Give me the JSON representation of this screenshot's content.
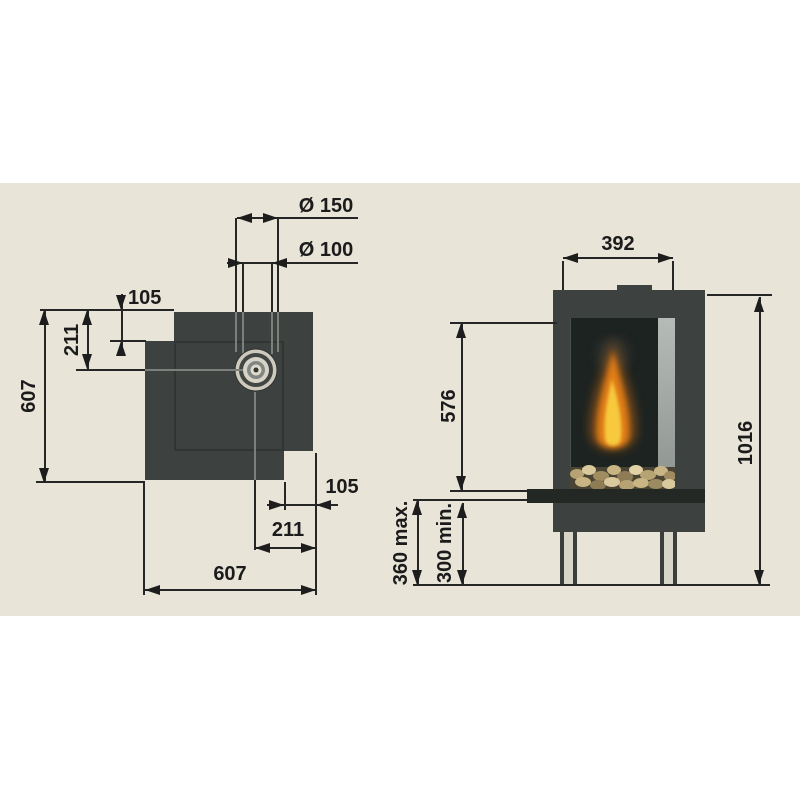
{
  "drawing": {
    "type": "fireplace installation dimension drawing",
    "views": [
      "top view",
      "front view"
    ]
  },
  "top_view": {
    "dims": {
      "flue_outer_diameter": "Ø 150",
      "flue_inner_diameter": "Ø 100",
      "step_depth": "105",
      "flue_offset_from_top": "211",
      "overall_depth": "607",
      "notch_width": "105",
      "flue_offset_from_right": "211",
      "overall_width": "607"
    }
  },
  "front_view": {
    "dims": {
      "front_width": "392",
      "glass_height": "576",
      "overall_height": "1016",
      "base_height_max": "360 max.",
      "base_height_min": "300 min."
    }
  },
  "colors": {
    "background_band": "#e9e4d8",
    "page": "#ffffff",
    "body_dark": "#3d4240",
    "bench_black": "#242825",
    "line": "#262626",
    "flame_orange": "#e68017",
    "flame_yellow": "#f7c93e",
    "pebbles_tan": "#c9b484"
  }
}
